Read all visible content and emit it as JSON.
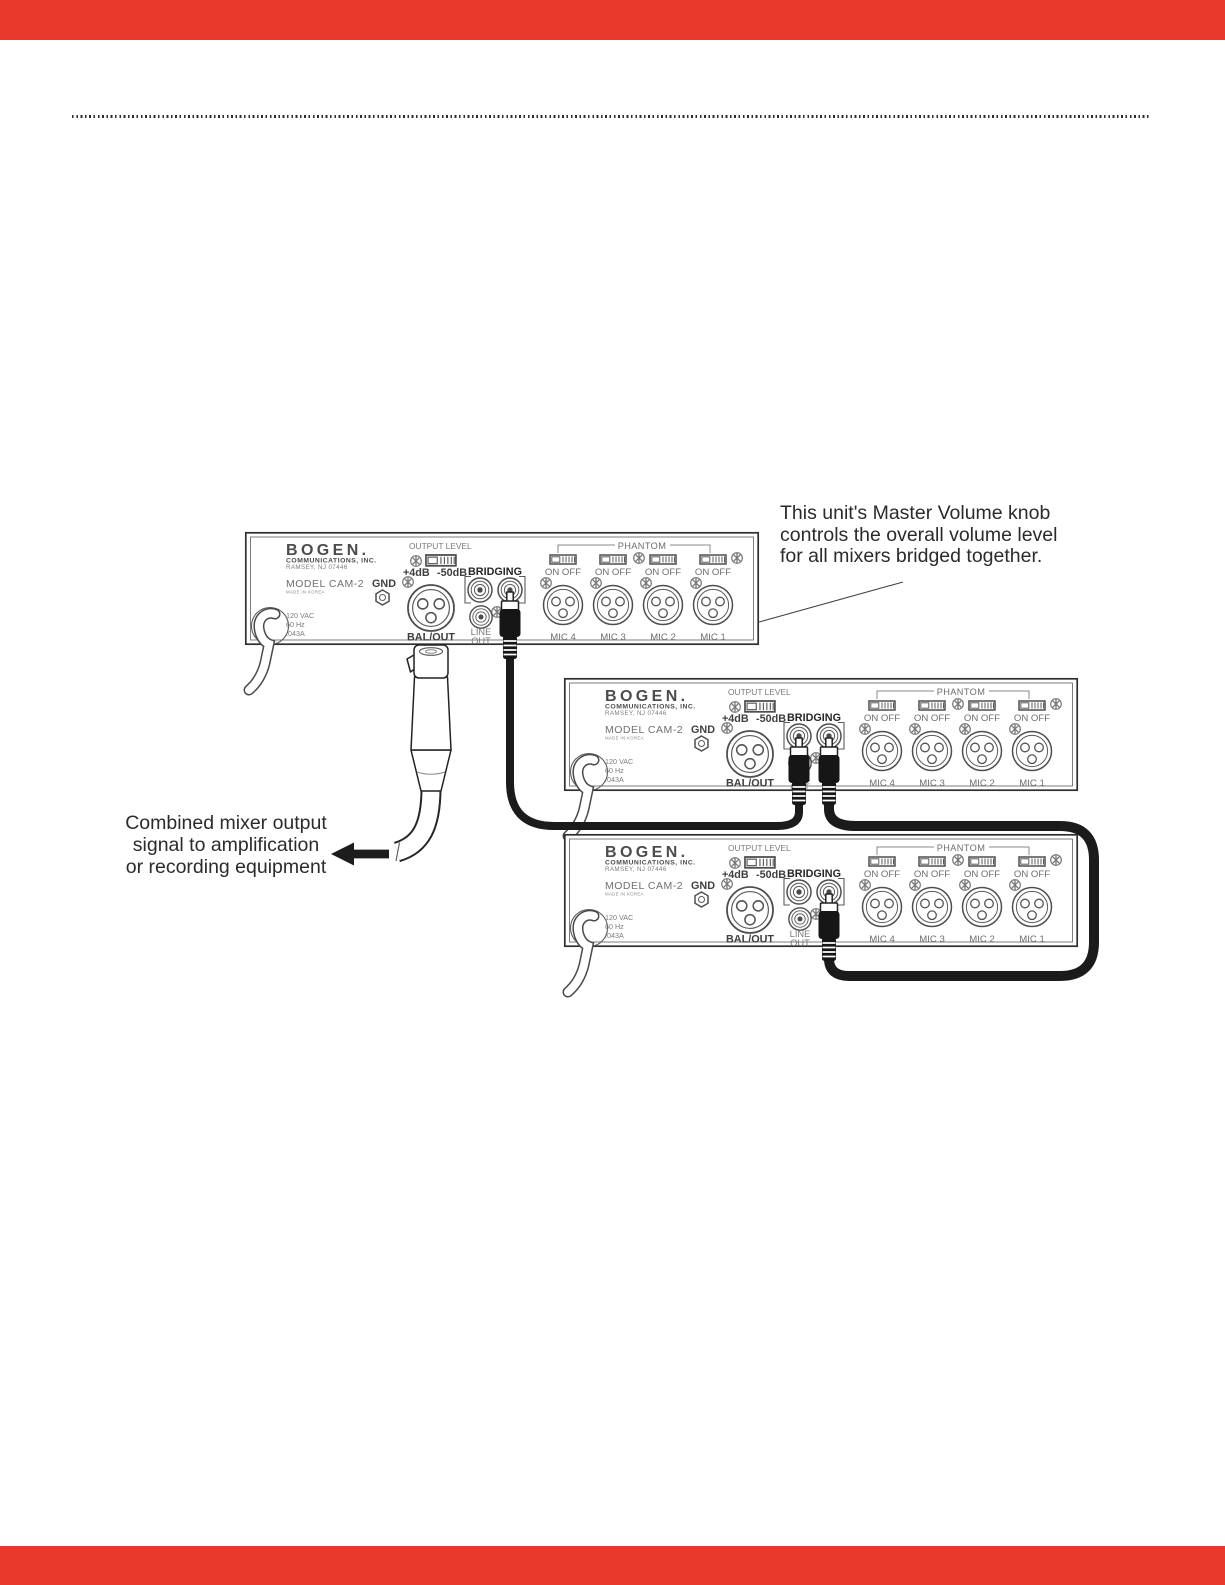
{
  "colors": {
    "redaction_red": "#e8392c",
    "ink": "#2b2b2b",
    "panel_gray": "#5b5b5b"
  },
  "callout_master_volume": {
    "line1": "This unit's Master Volume knob",
    "line2": "controls the overall volume level",
    "line3": "for all mixers bridged together."
  },
  "callout_output": {
    "line1": "Combined mixer output",
    "line2": "signal to amplification",
    "line3": "or recording equipment"
  },
  "panel": {
    "brand": "BOGEN.",
    "brand_sub": "COMMUNICATIONS, INC.",
    "brand_addr": "RAMSEY, NJ 07446",
    "model": "MODEL CAM-2",
    "made_in": "MADE IN KOREA",
    "power": [
      "120 VAC",
      "60 Hz",
      ".043A"
    ],
    "gnd": "GND",
    "output_level": "OUTPUT LEVEL",
    "level_plus": "+4dB",
    "level_minus": "-50dB",
    "bal_out": "BAL/OUT",
    "bridging": "BRIDGING",
    "line_out_1": "LINE",
    "line_out_2": "OUT",
    "phantom": "PHANTOM",
    "on_off": "ON OFF",
    "mics": [
      "MIC 4",
      "MIC 3",
      "MIC 2",
      "MIC 1"
    ]
  }
}
